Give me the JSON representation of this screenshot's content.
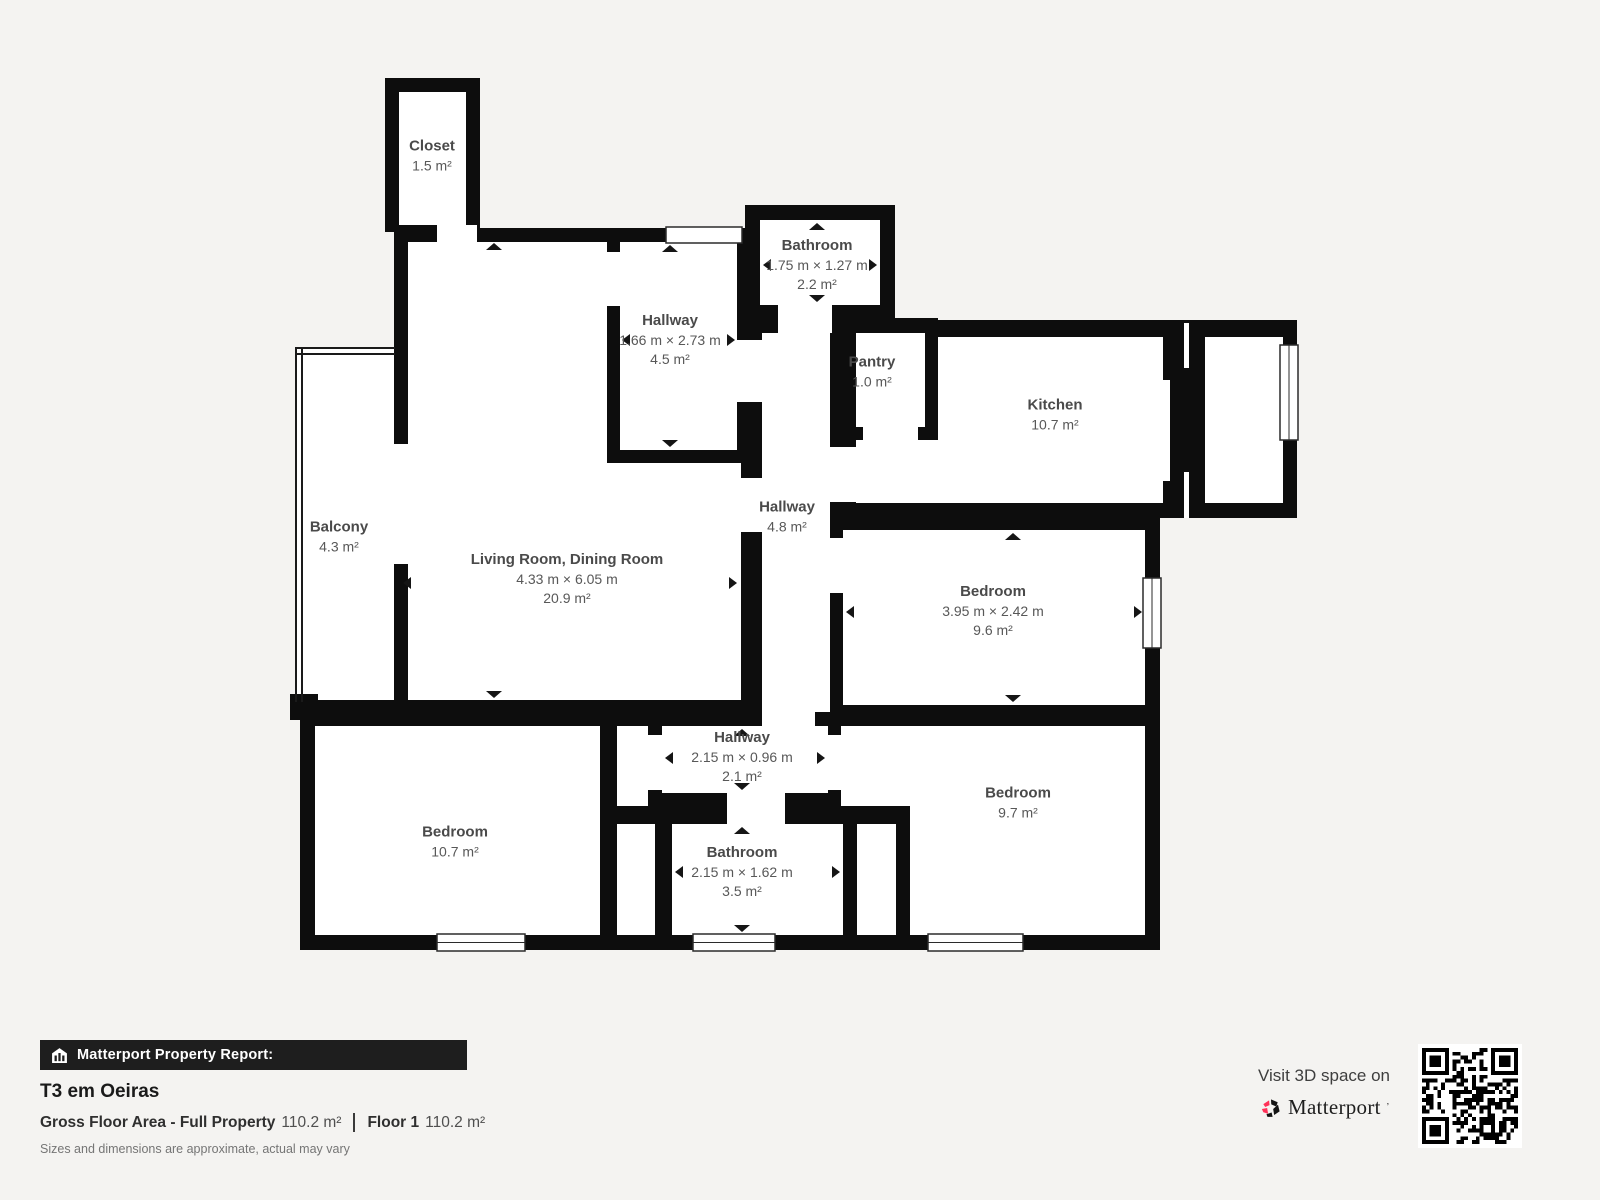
{
  "report": {
    "bar_label": "Matterport Property Report:",
    "property_title": "T3 em Oeiras",
    "gross_floor_area_label": "Gross Floor Area - Full Property",
    "gross_floor_area_value": "110.2 m²",
    "floor_label": "Floor 1",
    "floor_value": "110.2 m²",
    "disclaimer": "Sizes and dimensions are approximate, actual may vary",
    "visit_text": "Visit 3D space on",
    "brand": "Matterport"
  },
  "icons": {
    "bar_icon": "house-icon",
    "brand_icon": "matterport-pinwheel-icon",
    "qr": "qr-code"
  },
  "colors": {
    "background": "#f4f3f1",
    "wall": "#0d0d0d",
    "room": "#ffffff",
    "label": "#4a4a4a",
    "footer_bar": "#1e1e1e",
    "accent_red": "#ff3158"
  },
  "rooms": [
    {
      "id": "closet",
      "name": "Closet",
      "dims": "",
      "area": "1.5 m²"
    },
    {
      "id": "hallway-top",
      "name": "Hallway",
      "dims": "1.66 m × 2.73 m",
      "area": "4.5 m²"
    },
    {
      "id": "bathroom-top",
      "name": "Bathroom",
      "dims": "1.75 m × 1.27 m",
      "area": "2.2 m²"
    },
    {
      "id": "pantry",
      "name": "Pantry",
      "dims": "",
      "area": "1.0 m²"
    },
    {
      "id": "kitchen",
      "name": "Kitchen",
      "dims": "",
      "area": "10.7 m²"
    },
    {
      "id": "balcony",
      "name": "Balcony",
      "dims": "",
      "area": "4.3 m²"
    },
    {
      "id": "living-dining",
      "name": "Living Room, Dining Room",
      "dims": "4.33 m × 6.05 m",
      "area": "20.9 m²"
    },
    {
      "id": "hallway-mid",
      "name": "Hallway",
      "dims": "",
      "area": "4.8 m²"
    },
    {
      "id": "bedroom-right",
      "name": "Bedroom",
      "dims": "3.95 m × 2.42 m",
      "area": "9.6 m²"
    },
    {
      "id": "hallway-bottom",
      "name": "Hallway",
      "dims": "2.15 m × 0.96 m",
      "area": "2.1 m²"
    },
    {
      "id": "bedroom-bottom-left",
      "name": "Bedroom",
      "dims": "",
      "area": "10.7 m²"
    },
    {
      "id": "bathroom-bottom",
      "name": "Bathroom",
      "dims": "2.15 m × 1.62 m",
      "area": "3.5 m²"
    },
    {
      "id": "bedroom-bottom-right",
      "name": "Bedroom",
      "dims": "",
      "area": "9.7 m²"
    }
  ]
}
